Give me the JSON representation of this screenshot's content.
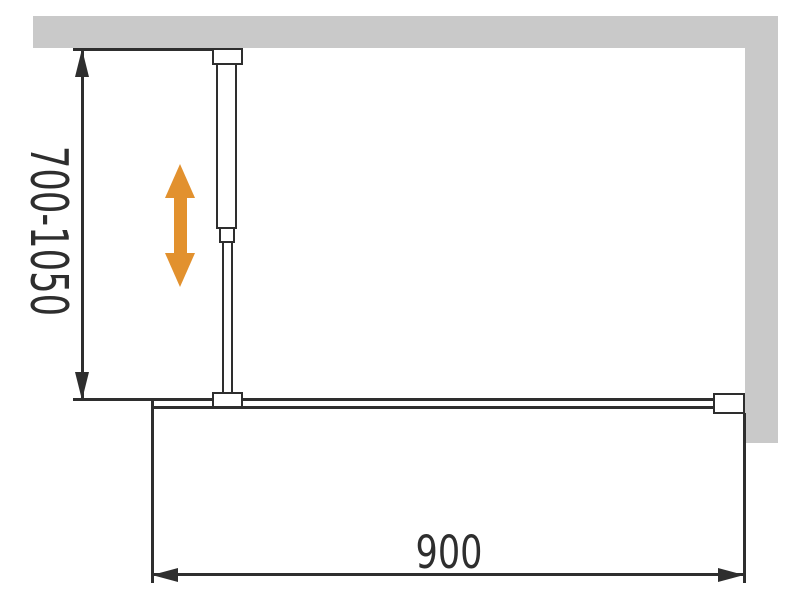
{
  "diagram": {
    "title": "walk-in shower screen installation drawing",
    "labels": {
      "height_range": "700-1050",
      "width": "900"
    },
    "colors": {
      "wall": "#c9c9c9",
      "line": "#2e2e2e",
      "arrow": "#e2912e",
      "background": "#ffffff"
    },
    "icons": {
      "adjustability_arrow": "vertical-double-arrow",
      "dimension_arrows": "filled-triangle-arrowheads"
    }
  }
}
